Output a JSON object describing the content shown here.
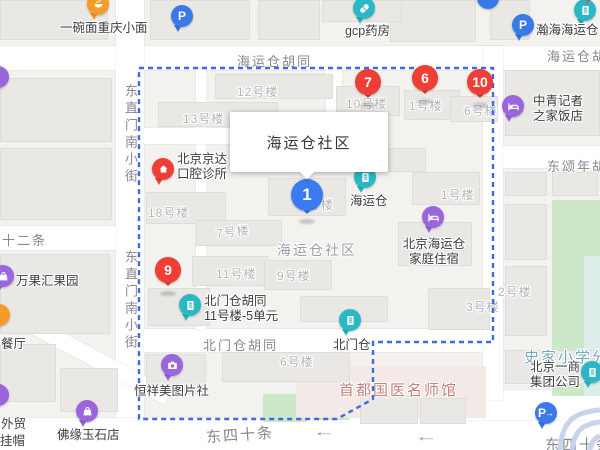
{
  "map": {
    "palette": {
      "teal": "#2BB8C6",
      "purple": "#9B66DB",
      "blue": "#3A79E8",
      "orange": "#F59B28",
      "red": "#EF3E35",
      "marker_blue": "#3B7BF2",
      "boundary": "#3D6BE5",
      "road": "#FFFFFF",
      "bg": "#F3F2EF",
      "building_fill": "#E9E8E4",
      "green": "#CDE7C9",
      "green_pale": "#DCEDEA",
      "pink_area": "#F3EAE7",
      "street_text": "#87878D",
      "building_text": "#B3B3B8",
      "poi_text": "#3C3C40",
      "area_text": "#9A9FA5",
      "school_text": "#74A9BF",
      "landmark_text": "#C4827A",
      "overpass": "#C9D4EC",
      "arrow": "#9A9AA0"
    },
    "info_window": {
      "text": "海运仓社区",
      "x": 230,
      "y": 112,
      "w": 158,
      "h": 60,
      "tail_x": 72
    },
    "boundary_points": "139,68 493,68 493,342 373,342 373,399 337,419 139,419 139,68",
    "overpass_paths": [
      "M560,450 C562,420 575,412 600,410",
      "M572,450 C574,430 584,424 600,422",
      "M590,450 C591,442 595,438 600,436"
    ],
    "roads": [
      {
        "x": 0,
        "y": 46,
        "w": 600,
        "h": 24
      },
      {
        "x": 116,
        "y": 0,
        "w": 28,
        "h": 450
      },
      {
        "x": 0,
        "y": 418,
        "w": 600,
        "h": 32
      },
      {
        "x": 370,
        "y": 390,
        "w": 230,
        "h": 30
      },
      {
        "x": 144,
        "y": 329,
        "w": 356,
        "h": 23
      },
      {
        "x": 483,
        "y": 46,
        "w": 20,
        "h": 354
      },
      {
        "x": 503,
        "y": 146,
        "w": 97,
        "h": 22
      },
      {
        "x": 326,
        "y": 70,
        "w": 16,
        "h": 76
      },
      {
        "x": 0,
        "y": 226,
        "w": 116,
        "h": 24
      },
      {
        "x": 196,
        "y": 70,
        "w": 10,
        "h": 260
      },
      {
        "x": 144,
        "y": 128,
        "w": 186,
        "h": 16
      },
      {
        "x": -30,
        "y": 340,
        "w": 210,
        "h": 16,
        "rot": 28
      }
    ],
    "greens": [
      {
        "x": 552,
        "y": 200,
        "w": 48,
        "h": 196,
        "c": "green"
      },
      {
        "x": 584,
        "y": 256,
        "w": 16,
        "h": 140,
        "c": "green_pale"
      },
      {
        "x": 263,
        "y": 394,
        "w": 44,
        "h": 28,
        "c": "green"
      },
      {
        "x": 312,
        "y": 392,
        "w": 38,
        "h": 28,
        "c": "green"
      }
    ],
    "pink_areas": [
      {
        "x": 296,
        "y": 366,
        "w": 190,
        "h": 52
      }
    ],
    "buildings": [
      [
        0,
        0,
        108,
        40
      ],
      [
        150,
        0,
        100,
        40
      ],
      [
        258,
        0,
        62,
        40
      ],
      [
        390,
        0,
        86,
        42
      ],
      [
        490,
        0,
        40,
        40
      ],
      [
        322,
        0,
        80,
        22
      ],
      [
        0,
        78,
        112,
        64
      ],
      [
        0,
        148,
        112,
        72
      ],
      [
        0,
        254,
        110,
        80
      ],
      [
        0,
        344,
        56,
        58
      ],
      [
        60,
        368,
        58,
        44
      ],
      [
        215,
        74,
        118,
        25
      ],
      [
        158,
        102,
        120,
        25
      ],
      [
        336,
        86,
        64,
        30
      ],
      [
        404,
        90,
        56,
        30
      ],
      [
        450,
        96,
        48,
        26
      ],
      [
        146,
        192,
        80,
        32
      ],
      [
        196,
        220,
        86,
        26
      ],
      [
        268,
        178,
        78,
        38
      ],
      [
        348,
        148,
        78,
        24
      ],
      [
        412,
        172,
        68,
        33
      ],
      [
        192,
        256,
        76,
        30
      ],
      [
        264,
        260,
        68,
        30
      ],
      [
        148,
        288,
        62,
        38
      ],
      [
        398,
        222,
        74,
        44
      ],
      [
        300,
        296,
        88,
        26
      ],
      [
        222,
        352,
        128,
        30
      ],
      [
        146,
        354,
        60,
        40
      ],
      [
        505,
        70,
        95,
        66
      ],
      [
        505,
        172,
        42,
        24
      ],
      [
        552,
        172,
        46,
        24
      ],
      [
        505,
        204,
        42,
        56
      ],
      [
        505,
        266,
        42,
        70
      ],
      [
        428,
        288,
        62,
        42
      ],
      [
        505,
        350,
        92,
        34
      ],
      [
        360,
        396,
        58,
        28
      ],
      [
        420,
        398,
        46,
        26
      ]
    ],
    "street_labels": [
      {
        "text": "海运仓胡同",
        "x": 237,
        "y": 51
      },
      {
        "text": "海运仓胡同",
        "x": 547,
        "y": 46
      },
      {
        "text": "东直门南小街",
        "x": 121,
        "y": 84,
        "vertical": true
      },
      {
        "text": "东直门南小街",
        "x": 121,
        "y": 250,
        "vertical": true
      },
      {
        "text": "十二条",
        "x": 2,
        "y": 230
      },
      {
        "text": "北门仓胡同",
        "x": 203,
        "y": 335
      },
      {
        "text": "东四十条",
        "x": 206,
        "y": 424,
        "rot": -4,
        "size": 15
      },
      {
        "text": "东四十条",
        "x": 545,
        "y": 434,
        "size": 15
      },
      {
        "text": "东颂年胡同",
        "x": 547,
        "y": 156
      }
    ],
    "building_labels": [
      {
        "text": "12号楼",
        "x": 237,
        "y": 83
      },
      {
        "text": "13号楼",
        "x": 183,
        "y": 110
      },
      {
        "text": "18号楼",
        "x": 148,
        "y": 204
      },
      {
        "text": "7号楼",
        "x": 216,
        "y": 223,
        "rot": -6
      },
      {
        "text": "11号楼",
        "x": 216,
        "y": 265
      },
      {
        "text": "9号楼",
        "x": 277,
        "y": 267
      },
      {
        "text": "10号楼",
        "x": 346,
        "y": 95
      },
      {
        "text": "1号楼",
        "x": 409,
        "y": 97
      },
      {
        "text": "6号楼",
        "x": 464,
        "y": 102
      },
      {
        "text": "号楼",
        "x": 308,
        "y": 196
      },
      {
        "text": "1号楼",
        "x": 441,
        "y": 186
      },
      {
        "text": "2号楼",
        "x": 498,
        "y": 283
      },
      {
        "text": "3号楼",
        "x": 466,
        "y": 298
      },
      {
        "text": "6号楼",
        "x": 280,
        "y": 353
      }
    ],
    "area_labels": [
      {
        "text": "海运仓社区",
        "x": 277,
        "y": 240,
        "cls": "area"
      },
      {
        "text": "史家小学分",
        "x": 524,
        "y": 346,
        "cls": "school"
      },
      {
        "text": "首都国医名师馆",
        "x": 339,
        "y": 379,
        "cls": "landmark"
      }
    ],
    "poi_labels": [
      {
        "lines": [
          "一碗面重庆小面"
        ],
        "x": 60,
        "y": 21
      },
      {
        "lines": [
          "gcp药房"
        ],
        "x": 345,
        "y": 24
      },
      {
        "lines": [
          "瀚海海运仓"
        ],
        "x": 536,
        "y": 23
      },
      {
        "lines": [
          "中青记者",
          "之家饭店"
        ],
        "x": 533,
        "y": 94
      },
      {
        "lines": [
          "北京京达",
          "口腔诊所"
        ],
        "x": 177,
        "y": 152
      },
      {
        "lines": [
          "海运仓"
        ],
        "x": 350,
        "y": 194
      },
      {
        "lines": [
          "北京海运仓",
          "家庭住宿"
        ],
        "x": 399,
        "y": 237,
        "center": true,
        "w": 70
      },
      {
        "lines": [
          "北门仓胡同",
          "11号楼-5单元"
        ],
        "x": 204,
        "y": 294
      },
      {
        "lines": [
          "北门仓"
        ],
        "x": 333,
        "y": 338
      },
      {
        "lines": [
          "恒祥美图片社"
        ],
        "x": 134,
        "y": 384
      },
      {
        "lines": [
          "佛缘玉石店"
        ],
        "x": 57,
        "y": 428
      },
      {
        "lines": [
          "万果汇果园"
        ],
        "x": 16,
        "y": 274
      },
      {
        "lines": [
          "北京一商",
          "集团公司"
        ],
        "x": 530,
        "y": 360
      },
      {
        "lines": [
          "餐厅"
        ],
        "x": 1,
        "y": 337
      },
      {
        "lines": [
          "外贸"
        ],
        "x": 1,
        "y": 417
      },
      {
        "lines": [
          "挂帽"
        ],
        "x": 0,
        "y": 434
      }
    ],
    "markers": [
      {
        "kind": "num",
        "n": "1",
        "color": "marker_blue",
        "x": 307,
        "y": 195,
        "big": true,
        "name": "result-marker-1"
      },
      {
        "kind": "num",
        "n": "6",
        "color": "red",
        "x": 425,
        "y": 78,
        "name": "result-marker-6"
      },
      {
        "kind": "num",
        "n": "7",
        "color": "red",
        "x": 368,
        "y": 82,
        "name": "result-marker-7"
      },
      {
        "kind": "num",
        "n": "9",
        "color": "red",
        "x": 168,
        "y": 270,
        "name": "result-marker-9"
      },
      {
        "kind": "num",
        "n": "10",
        "color": "red",
        "x": 480,
        "y": 82,
        "name": "result-marker-10"
      },
      {
        "kind": "poi",
        "icon": "pill",
        "color": "teal",
        "x": 364,
        "y": 8,
        "name": "pharmacy-marker"
      },
      {
        "kind": "poi",
        "icon": "bowl",
        "color": "orange",
        "x": 98,
        "y": 4,
        "name": "restaurant-marker"
      },
      {
        "kind": "poi",
        "icon": "parking",
        "color": "blue",
        "x": 182,
        "y": 16,
        "name": "parking-marker"
      },
      {
        "kind": "poi",
        "icon": "parking",
        "color": "blue",
        "x": 523,
        "y": 25,
        "name": "parking-marker"
      },
      {
        "kind": "poi",
        "icon": "parking-entrance",
        "color": "blue",
        "x": 546,
        "y": 413,
        "name": "parking-entrance-marker"
      },
      {
        "kind": "poi",
        "icon": "building-flag",
        "color": "teal",
        "x": 585,
        "y": 10,
        "name": "scenic-marker"
      },
      {
        "kind": "poi",
        "icon": "building",
        "color": "teal",
        "x": 365,
        "y": 177,
        "name": "place-marker-haiyuncang"
      },
      {
        "kind": "poi",
        "icon": "building",
        "color": "teal",
        "x": 190,
        "y": 305,
        "name": "place-marker-unit"
      },
      {
        "kind": "poi",
        "icon": "building",
        "color": "teal",
        "x": 350,
        "y": 320,
        "name": "place-marker-beimencang"
      },
      {
        "kind": "poi",
        "icon": "building",
        "color": "teal",
        "x": 592,
        "y": 372,
        "name": "company-marker"
      },
      {
        "kind": "poi",
        "icon": "bed",
        "color": "purple",
        "x": 513,
        "y": 106,
        "name": "hotel-marker"
      },
      {
        "kind": "poi",
        "icon": "bed",
        "color": "purple",
        "x": 433,
        "y": 217,
        "name": "lodging-marker"
      },
      {
        "kind": "poi",
        "icon": "camera",
        "color": "purple",
        "x": 172,
        "y": 365,
        "name": "photo-studio-marker"
      },
      {
        "kind": "poi",
        "icon": "bag",
        "color": "purple",
        "x": 87,
        "y": 411,
        "name": "shop-marker"
      },
      {
        "kind": "poi",
        "icon": "bag",
        "color": "purple",
        "x": 3,
        "y": 276,
        "name": "shop-marker"
      },
      {
        "kind": "poi",
        "icon": "house",
        "color": "red",
        "x": 163,
        "y": 169,
        "name": "clinic-marker"
      },
      {
        "kind": "dot",
        "color": "purple",
        "x": -2,
        "y": 77,
        "name": "poi-dot-marker"
      },
      {
        "kind": "dot",
        "color": "purple",
        "x": -2,
        "y": 395,
        "name": "poi-dot-marker"
      },
      {
        "kind": "dot",
        "color": "orange",
        "x": -1,
        "y": 315,
        "name": "poi-dot-marker"
      },
      {
        "kind": "dot",
        "color": "blue",
        "x": 488,
        "y": -2,
        "name": "poi-dot-marker"
      }
    ],
    "arrows": [
      {
        "x": 318,
        "y": 424
      },
      {
        "x": 420,
        "y": 429
      }
    ]
  }
}
